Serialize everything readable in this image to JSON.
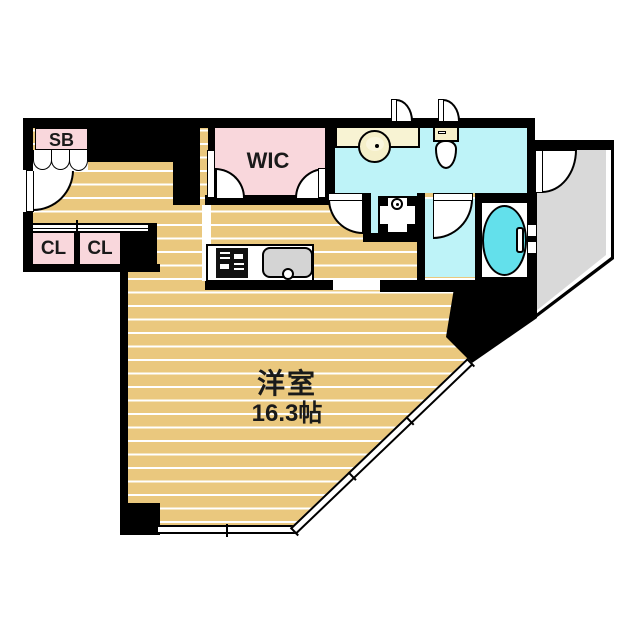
{
  "plan_title": "apartment floor plan",
  "rooms": {
    "shoe_box": {
      "label": "SB"
    },
    "walk_in_closet": {
      "label": "WIC"
    },
    "closet_left": {
      "label": "CL"
    },
    "closet_right": {
      "label": "CL"
    },
    "main_room": {
      "name": "洋室",
      "size": "16.3帖"
    }
  },
  "fixtures": {
    "entrance_door": "entrance-swing-door",
    "shoe_box_door": "accordion-door",
    "wash_basin": "round-basin-on-vanity",
    "toilet": "toilet",
    "washing_machine_pan": "washing-machine-pan",
    "bathtub": "bathtub",
    "stove": "gas-stove",
    "kitchen_sink": "kitchen-sink",
    "balcony": "balcony",
    "windows": "sliding-windows"
  },
  "colors": {
    "wall": "#000000",
    "flooring": "#eac87e",
    "flooring_stripe": "#ffffff",
    "closet_pink": "#f9d7dc",
    "wet_area_cyan": "#bef3f8",
    "bathtub_cyan": "#63e0eb",
    "vanity_cream": "#f8f3d3",
    "balcony_gray": "#d9d9d9",
    "sink_gray": "#d4d4d4"
  }
}
